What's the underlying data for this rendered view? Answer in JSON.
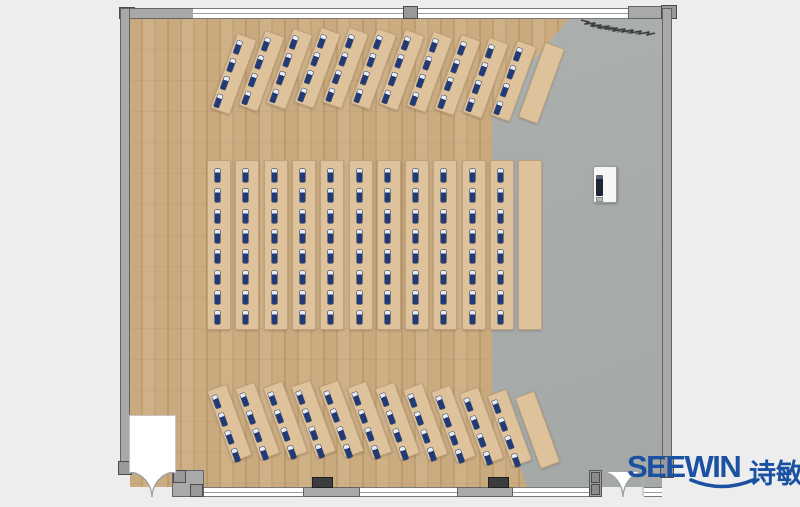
{
  "logo": {
    "text_en": "SEEWIN",
    "text_cn": "诗敏"
  },
  "colors": {
    "background": "#ecedec",
    "wood_floor": "#c8a87d",
    "gray_floor": "#a9ada9",
    "desk": "#dec29b",
    "wall": "#a9a9a9",
    "seat_mark_navy": "#1f3a77",
    "logo_blue": "#1b51a3",
    "column_dark": "#3c3c3c"
  },
  "plan": {
    "description": "training-room floor plan, desks facing right toward screen unit",
    "sections": [
      {
        "id": "top",
        "angle_deg": 20,
        "rows": 12,
        "rows_with_seats": 11,
        "seats_per_row": 4,
        "origin_x": 223,
        "origin_y": 28,
        "spacing_x": 28,
        "row_w": 21,
        "row_len": 80,
        "seat_left": 2,
        "seat_start": 6,
        "seat_gap": 19,
        "y_offsets": [
          6,
          3,
          1,
          0,
          0,
          1,
          2,
          4,
          7,
          10,
          13,
          15
        ]
      },
      {
        "id": "middle",
        "angle_deg": 0,
        "rows": 12,
        "rows_with_seats": 11,
        "seats_per_row": 8,
        "origin_x": 207,
        "origin_y": 160,
        "spacing_x": 28.3,
        "row_w": 24,
        "row_len": 170,
        "seat_left": 7,
        "seat_start": 8,
        "seat_gap": 20.3,
        "y_offsets": [
          0,
          0,
          0,
          0,
          0,
          0,
          0,
          0,
          0,
          0,
          0,
          0
        ]
      },
      {
        "id": "bottom",
        "angle_deg": -20,
        "rows": 12,
        "rows_with_seats": 11,
        "seats_per_row": 4,
        "origin_x": 219,
        "origin_y": 381,
        "spacing_x": 28,
        "row_w": 21,
        "row_len": 76,
        "seat_left": 2,
        "seat_start": 6,
        "seat_gap": 19,
        "y_offsets": [
          4,
          2,
          1,
          0,
          0,
          1,
          2,
          3,
          5,
          7,
          9,
          11
        ]
      }
    ],
    "objects": [
      {
        "id": "screen-unit",
        "label": "mobile display / whiteboard unit on gray floor"
      },
      {
        "id": "entrance-door-left",
        "label": "double swing door bottom-left"
      },
      {
        "id": "entrance-door-right",
        "label": "double swing door bottom-right"
      },
      {
        "id": "wall-columns",
        "label": "2 structural columns on bottom wall"
      },
      {
        "id": "scribble",
        "label": "pencil scribble mark near top-right wall"
      }
    ]
  }
}
